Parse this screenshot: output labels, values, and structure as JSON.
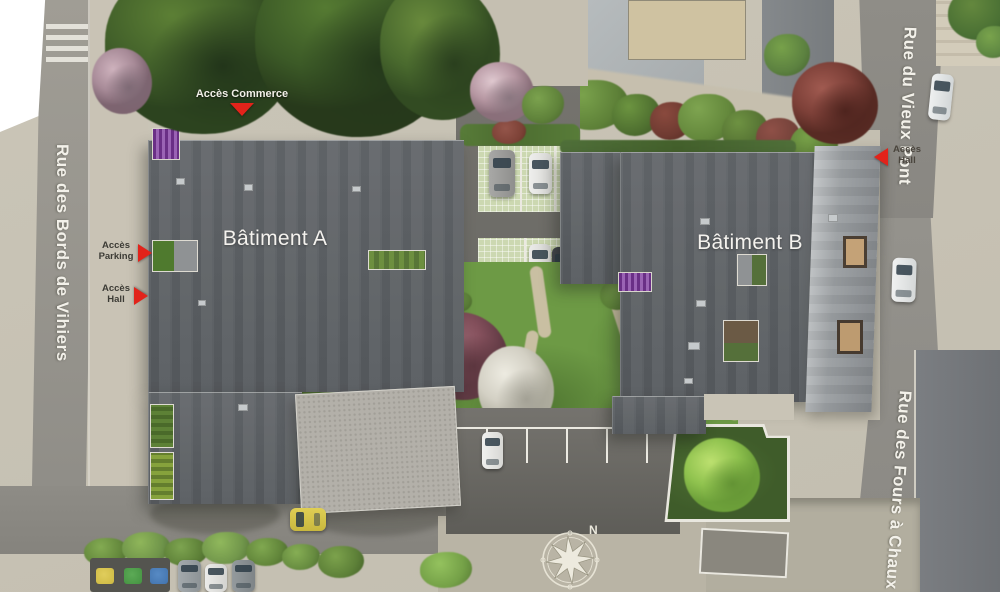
{
  "plan": {
    "streets": {
      "west": "Rue des Bords de Vihiers",
      "northeast": "Rue du Vieux Pont",
      "southeast": "Rue des Fours à Chaux"
    },
    "buildings": {
      "a": "Bâtiment A",
      "b": "Bâtiment B"
    },
    "access": {
      "commerce": "Accès Commerce",
      "parking": "Accès Parking",
      "hall_west": "Accès Hall",
      "hall_east": "Accès Hall"
    },
    "compass": {
      "north": "N"
    },
    "colors": {
      "marker_red": "#e2231a",
      "roof_dark": "#5e6266",
      "roof_light": "#b3b0a9",
      "lawn_green": "#6d9a45",
      "road_gray": "#92908a",
      "pavement": "#c8c3b5"
    }
  }
}
